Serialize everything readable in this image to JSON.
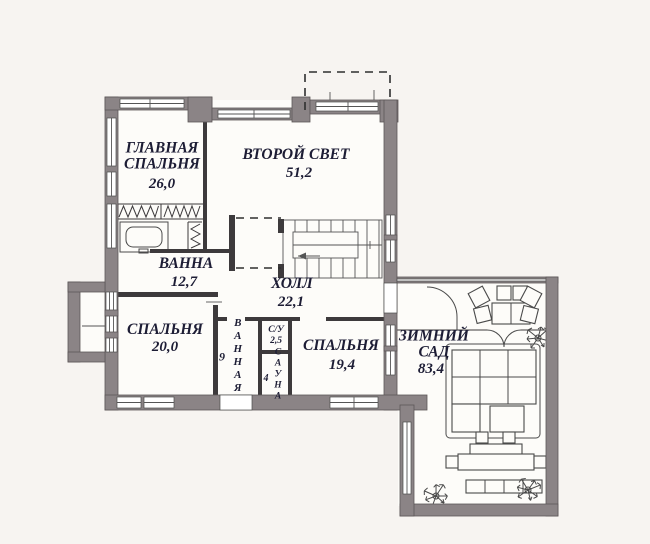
{
  "plan_type": "floor-plan",
  "language": "ru",
  "colors": {
    "wall": "#8b8486",
    "interior_wall": "#3d3a3c",
    "floor": "#fdfcf9",
    "background": "#f7f4f1",
    "text": "#1d1d35"
  },
  "rooms": {
    "master_bedroom": {
      "name": "ГЛАВНАЯ СПАЛЬНЯ",
      "area": "26,0"
    },
    "second_light": {
      "name": "ВТОРОЙ СВЕТ",
      "area": "51,2"
    },
    "bath": {
      "name": "ВАННА",
      "area": "12,7"
    },
    "hall": {
      "name": "ХОЛЛ",
      "area": "22,1"
    },
    "bedroom_20": {
      "name": "СПАЛЬНЯ",
      "area": "20,0"
    },
    "bathroom_9": {
      "name": "ВАННАЯ",
      "area": "9"
    },
    "wc": {
      "name": "С/У",
      "area": "2,5"
    },
    "sauna": {
      "name": "САУНА",
      "area": "4"
    },
    "bedroom_19": {
      "name": "СПАЛЬНЯ",
      "area": "19,4"
    },
    "winter_garden": {
      "name": "ЗИМНИЙ САД",
      "area": "83,4"
    }
  },
  "icons": {
    "staircase": "stairs-icon",
    "bathtub": "bathtub-icon",
    "wardrobe": "wardrobe-hangers-icon",
    "sofa": "sectional-sofa-icon",
    "dining": "dining-table-icon",
    "desk": "desk-icon",
    "bench": "bench-icon",
    "plant": "plant-icon",
    "door": "door-arc-icon",
    "window": "window-icon"
  }
}
